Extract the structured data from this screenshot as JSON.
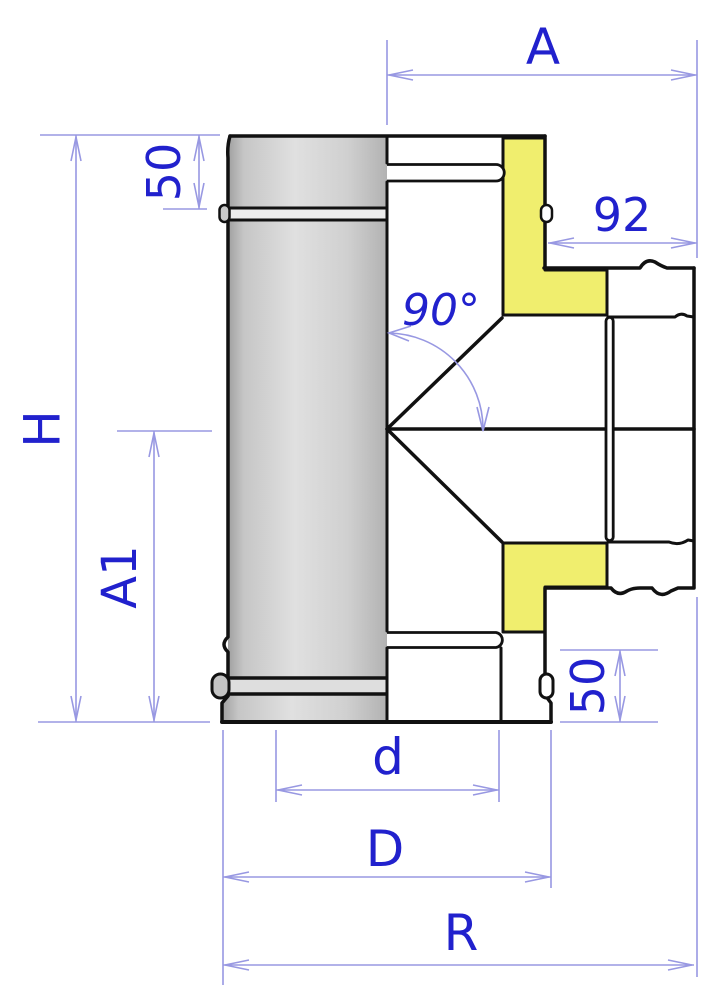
{
  "labels": {
    "A": "A",
    "socket92": "92",
    "top50": "50",
    "H": "H",
    "A1": "A1",
    "bottom50": "50",
    "angle": "90°",
    "d": "d",
    "D": "D",
    "R": "R"
  },
  "colors": {
    "dimension_line": "#9898e2",
    "dimension_text": "#2121cd",
    "insulation_yellow": "#f0ee6e",
    "outline_black": "#111111",
    "metal_gray_light": "#e2e2e2",
    "metal_gray_dark": "#a6a6a6",
    "background": "#ffffff"
  }
}
